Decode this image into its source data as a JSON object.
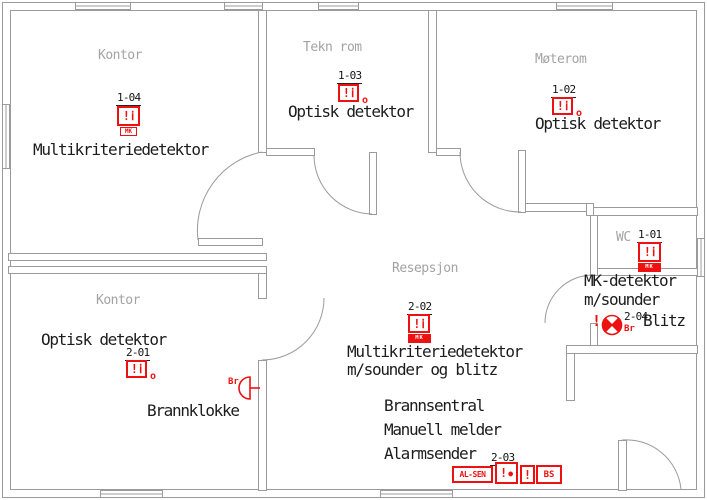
{
  "colors": {
    "wall": "#9b9b9b",
    "device_red": "#ee1111",
    "text": "#1c1c1c",
    "room_label": "#a3a3a3"
  },
  "rooms": {
    "kontor1": {
      "label": "Kontor"
    },
    "teknrom": {
      "label": "Tekn rom"
    },
    "moterom": {
      "label": "Møterom"
    },
    "resepsjon": {
      "label": "Resepsjon"
    },
    "wc": {
      "label": "WC"
    },
    "kontor2": {
      "label": "Kontor"
    }
  },
  "devices": {
    "d104": {
      "id": "1-04",
      "glyph1": "!",
      "glyph2": "ⅰ",
      "tag": "MK",
      "name": "Multikriteriedetektor"
    },
    "d103": {
      "id": "1-03",
      "glyph1": "!",
      "glyph2": "ⅰ",
      "suffix": "o",
      "name": "Optisk detektor"
    },
    "d102": {
      "id": "1-02",
      "glyph1": "!",
      "glyph2": "ⅰ",
      "suffix": "o",
      "name": "Optisk detektor"
    },
    "d101": {
      "id": "1-01",
      "glyph1": "!",
      "glyph2": "ⅰ",
      "tag": "MK",
      "name_line1": "MK-detektor",
      "name_line2": "m/sounder"
    },
    "d204": {
      "id": "2-04",
      "glyph1": "!",
      "suffix": "Br",
      "name": "Blitz"
    },
    "d202": {
      "id": "2-02",
      "glyph1": "!",
      "glyph2": "ⅰ",
      "tag": "MK",
      "name_line1": "Multikriteriedetektor",
      "name_line2": "m/sounder og blitz"
    },
    "d201": {
      "id": "2-01",
      "glyph1": "!",
      "glyph2": "ⅰ",
      "suffix": "o",
      "name": "Optisk detektor"
    },
    "d203": {
      "id": "2-03",
      "name_line1": "Brannsentral",
      "name_line2": "Manuell melder",
      "name_line3": "Alarmsender",
      "box1": "AL-SEN",
      "box2_glyph": "!",
      "box2_dot": "●",
      "box3": "!",
      "box4": "BS"
    },
    "bell": {
      "suffix": "Br",
      "name": "Brannklokke"
    }
  }
}
